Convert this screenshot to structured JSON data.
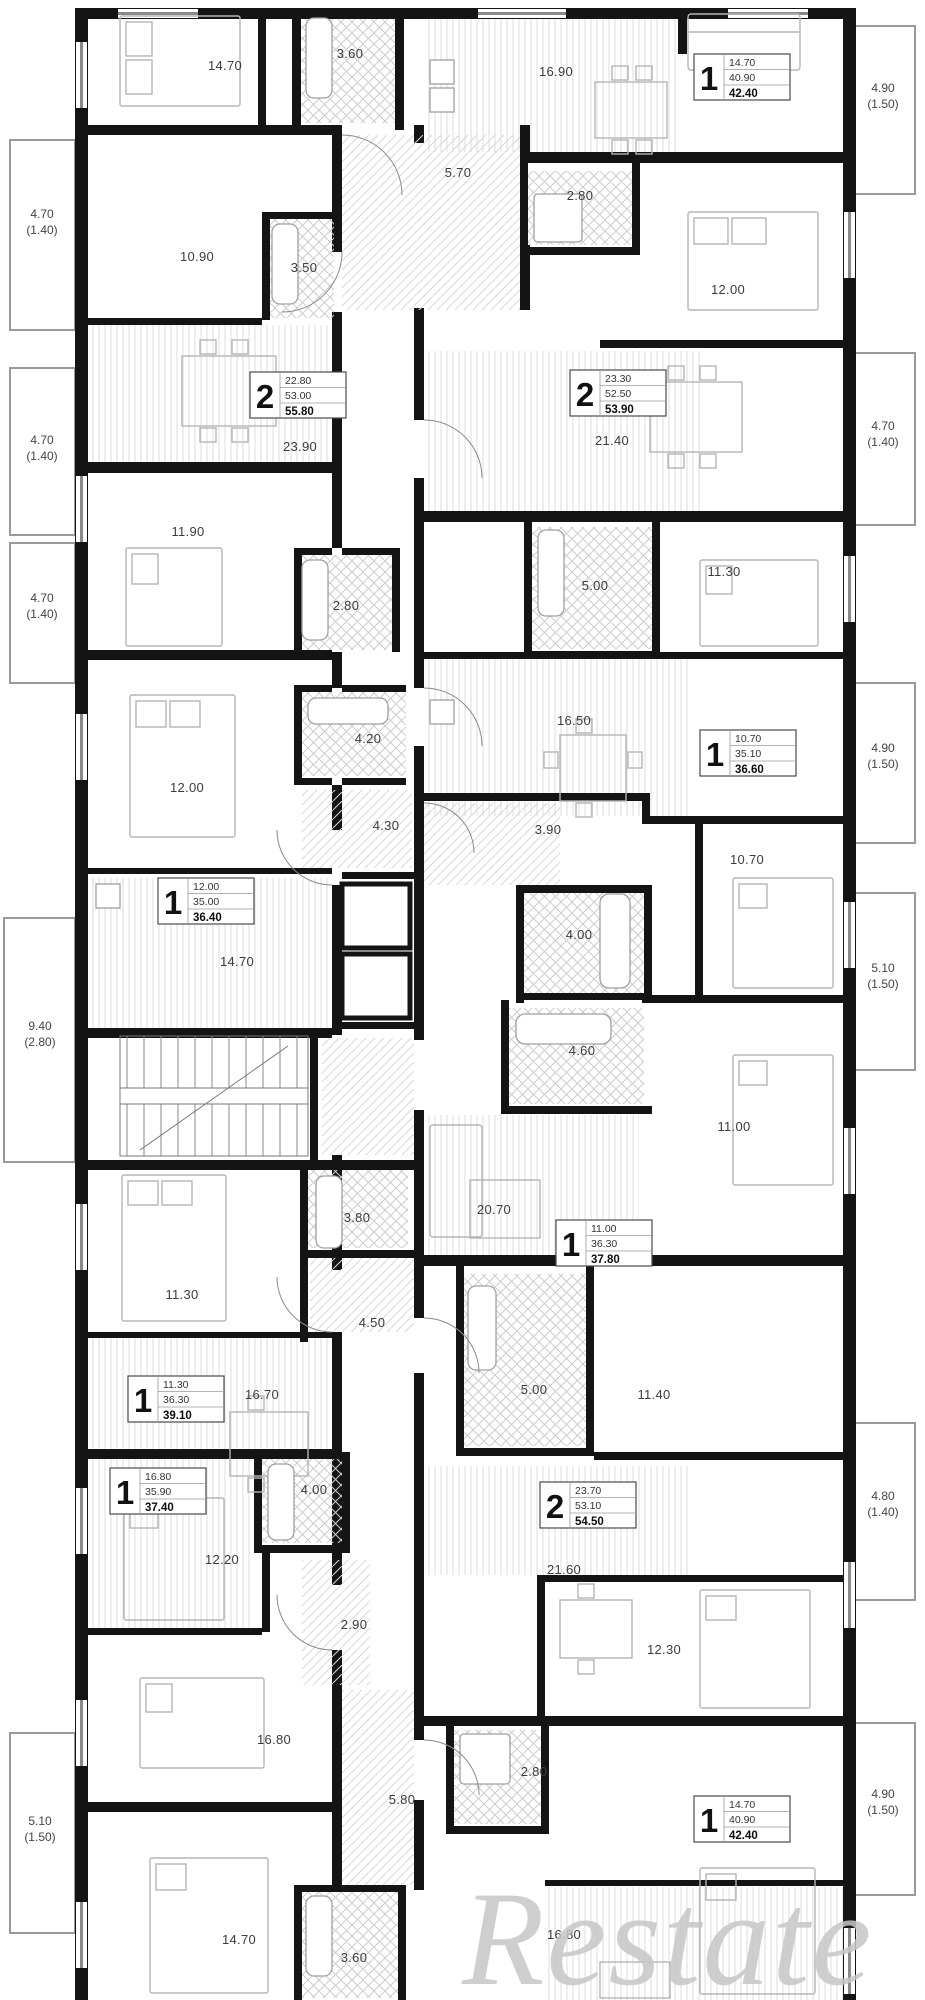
{
  "watermark": "Restate",
  "rooms": [
    {
      "label": "14.70"
    },
    {
      "label": "3.60"
    },
    {
      "label": "16.90"
    },
    {
      "label": "5.70"
    },
    {
      "label": "10.90"
    },
    {
      "label": "3.50"
    },
    {
      "label": "2.80"
    },
    {
      "label": "12.00"
    },
    {
      "label": "23.90"
    },
    {
      "label": "21.40"
    },
    {
      "label": "11.90"
    },
    {
      "label": "2.80"
    },
    {
      "label": "5.00"
    },
    {
      "label": "11.30"
    },
    {
      "label": "16.50"
    },
    {
      "label": "12.00"
    },
    {
      "label": "4.20"
    },
    {
      "label": "4.30"
    },
    {
      "label": "3.90"
    },
    {
      "label": "10.70"
    },
    {
      "label": "14.70"
    },
    {
      "label": "4.00"
    },
    {
      "label": "4.60"
    },
    {
      "label": "11.00"
    },
    {
      "label": "20.70"
    },
    {
      "label": "3.80"
    },
    {
      "label": "11.30"
    },
    {
      "label": "4.50"
    },
    {
      "label": "16.70"
    },
    {
      "label": "5.00"
    },
    {
      "label": "11.40"
    },
    {
      "label": "4.00"
    },
    {
      "label": "12.20"
    },
    {
      "label": "21.60"
    },
    {
      "label": "2.90"
    },
    {
      "label": "12.30"
    },
    {
      "label": "16.80"
    },
    {
      "label": "2.80"
    },
    {
      "label": "5.80"
    },
    {
      "label": "14.70"
    },
    {
      "label": "3.60"
    },
    {
      "label": "16.80"
    }
  ],
  "balconies": [
    {
      "area": "4.70",
      "glazed": "(1.40)"
    },
    {
      "area": "4.70",
      "glazed": "(1.40)"
    },
    {
      "area": "4.70",
      "glazed": "(1.40)"
    },
    {
      "area": "9.40",
      "glazed": "(2.80)"
    },
    {
      "area": "5.10",
      "glazed": "(1.50)"
    },
    {
      "area": "4.90",
      "glazed": "(1.50)"
    },
    {
      "area": "4.70",
      "glazed": "(1.40)"
    },
    {
      "area": "4.90",
      "glazed": "(1.50)"
    },
    {
      "area": "5.10",
      "glazed": "(1.50)"
    },
    {
      "area": "4.80",
      "glazed": "(1.40)"
    },
    {
      "area": "4.90",
      "glazed": "(1.50)"
    }
  ],
  "apartments": [
    {
      "type": "1",
      "v1": "14.70",
      "v2": "40.90",
      "v3": "42.40"
    },
    {
      "type": "2",
      "v1": "22.80",
      "v2": "53.00",
      "v3": "55.80"
    },
    {
      "type": "2",
      "v1": "23.30",
      "v2": "52.50",
      "v3": "53.90"
    },
    {
      "type": "1",
      "v1": "10.70",
      "v2": "35.10",
      "v3": "36.60"
    },
    {
      "type": "1",
      "v1": "12.00",
      "v2": "35.00",
      "v3": "36.40"
    },
    {
      "type": "1",
      "v1": "11.00",
      "v2": "36.30",
      "v3": "37.80"
    },
    {
      "type": "1",
      "v1": "11.30",
      "v2": "36.30",
      "v3": "39.10"
    },
    {
      "type": "1",
      "v1": "16.80",
      "v2": "35.90",
      "v3": "37.40"
    },
    {
      "type": "2",
      "v1": "23.70",
      "v2": "53.10",
      "v3": "54.50"
    },
    {
      "type": "1",
      "v1": "14.70",
      "v2": "40.90",
      "v3": "42.40"
    }
  ]
}
